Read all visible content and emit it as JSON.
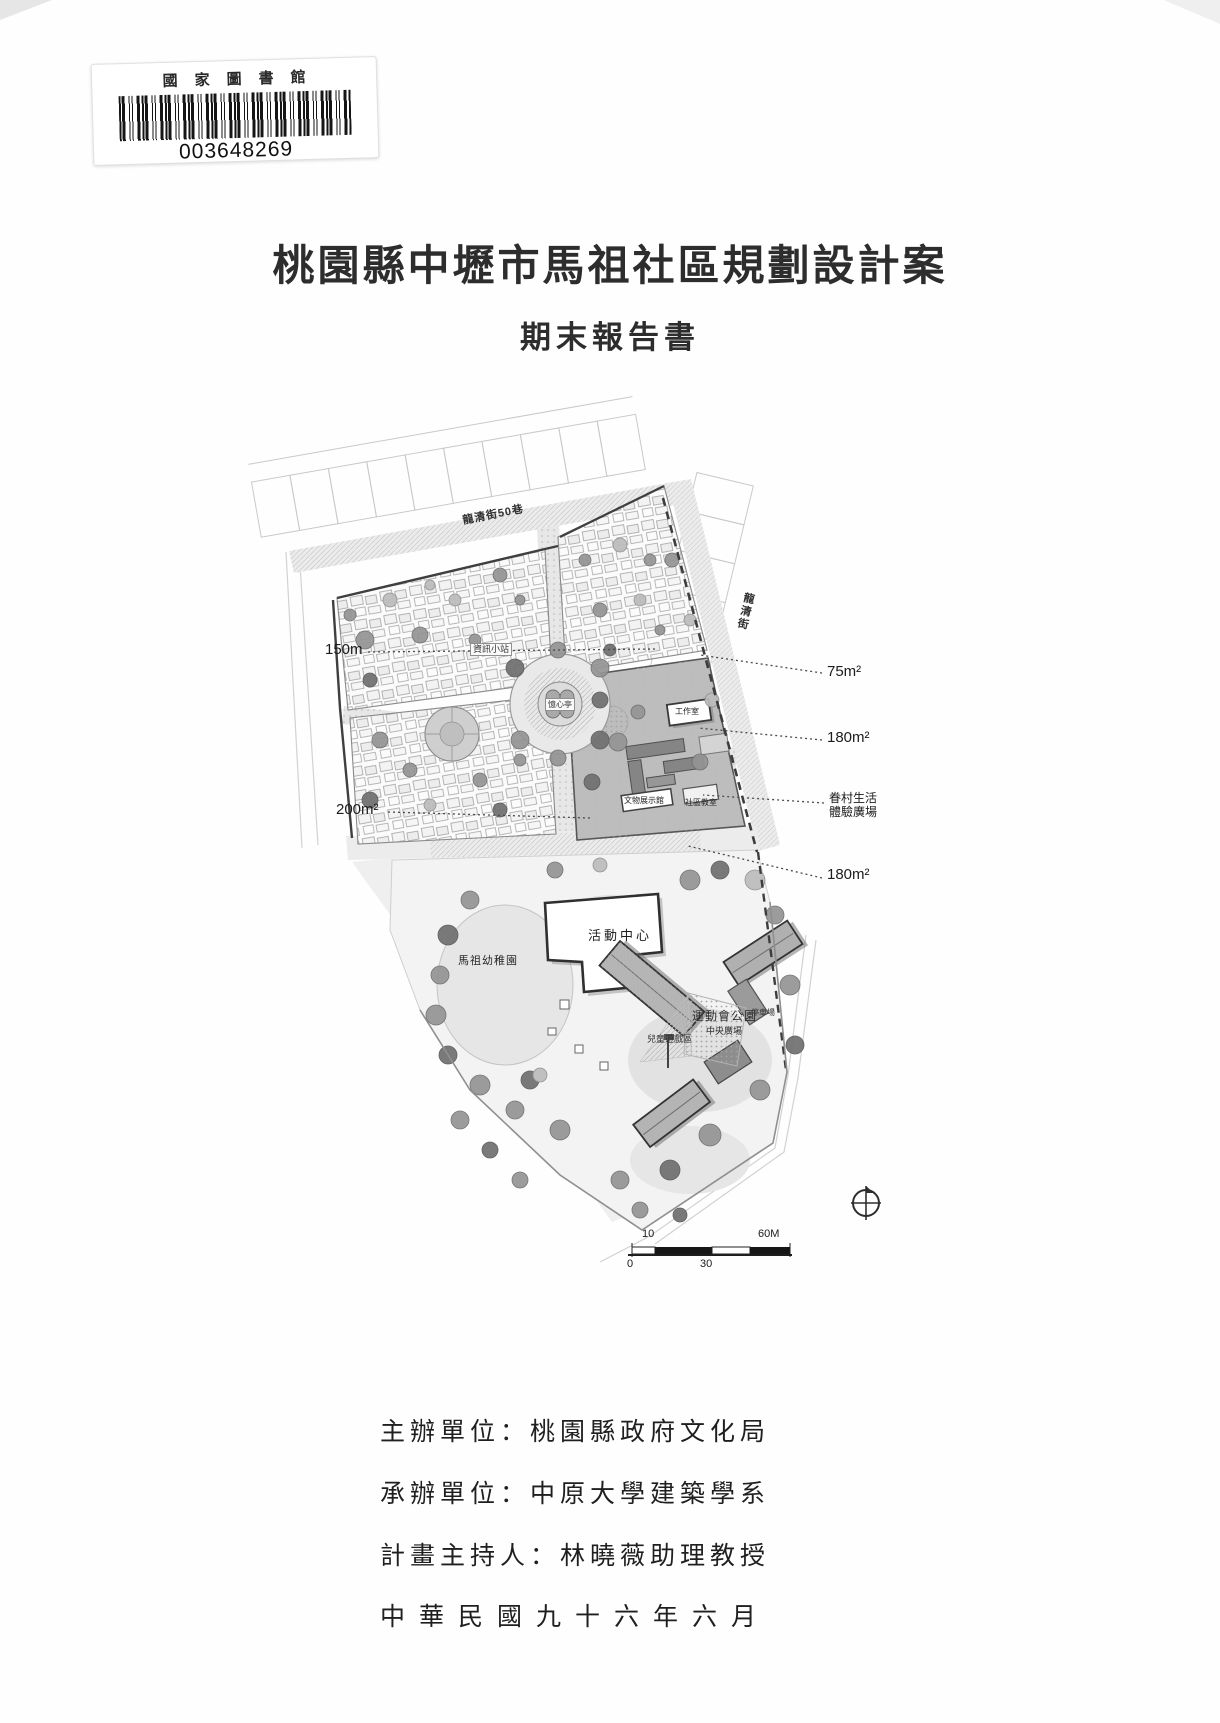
{
  "library_stamp": {
    "name": "國家圖書館",
    "barcode_number": "003648269"
  },
  "title": "桃園縣中壢市馬祖社區規劃設計案",
  "subtitle": "期末報告書",
  "map": {
    "streets": {
      "top": "龍清街50巷",
      "right": "龍清街"
    },
    "annotations": {
      "area_150m": "150m",
      "area_200m": "200m²",
      "area_75m": "75m²",
      "area_180m_upper": "180m²",
      "juancun_plaza_line1": "眷村生活",
      "juancun_plaza_line2": "體驗廣場",
      "area_180m_lower": "180m²"
    },
    "places": {
      "info_station": "資訊小站",
      "pavilion": "憶心亭",
      "workshop": "工作室",
      "artifact_hall": "文物展示館",
      "community_classroom": "社區教室",
      "activity_center": "活動中心",
      "sports_park": "運動會公園",
      "central_plaza": "中央廣場",
      "children_play_area": "兒童遊戲區",
      "kindergarten": "馬祖幼稚園",
      "parking": "停車場"
    },
    "scale_bar": {
      "top_left": "10",
      "top_right": "60M",
      "bottom_left": "0",
      "bottom_mid": "30"
    }
  },
  "footer": {
    "lines": [
      "主辦單位：桃園縣政府文化局",
      "承辦單位：中原大學建築學系",
      "計畫主持人：林曉薇助理教授",
      "中華民國九十六年六月"
    ]
  },
  "colors": {
    "ink": "#2d2d2d",
    "map_dark": "#3f3f3f",
    "map_mid": "#949494",
    "map_light": "#ececec"
  }
}
